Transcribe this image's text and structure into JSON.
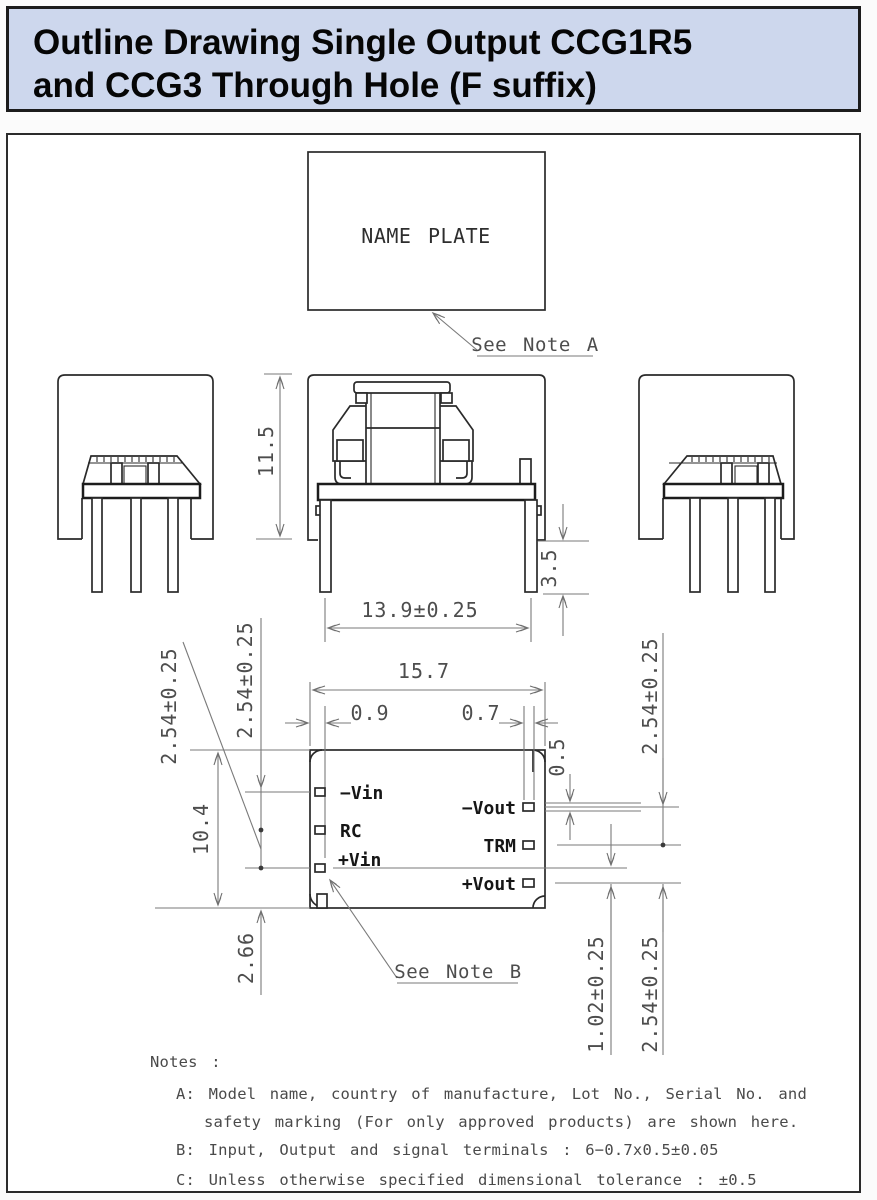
{
  "header": {
    "title_line1": "Outline Drawing Single Output CCG1R5",
    "title_line2": "and CCG3 Through Hole (F suffix)"
  },
  "colors": {
    "header_bg": "#cdd7ed",
    "border": "#1c1c1c",
    "outline": "#2a2a2a",
    "dimension": "#7a7a7a"
  },
  "name_plate": {
    "label": "NAME PLATE",
    "callout": "See Note A"
  },
  "bottom_view": {
    "callout": "See Note B",
    "pins_left": [
      "−Vin",
      "RC",
      "+Vin"
    ],
    "pins_right": [
      "−Vout",
      "TRM",
      "+Vout"
    ]
  },
  "dimensions": {
    "module_height": "11.5",
    "standoff_height": "3.5",
    "pin_row_span": "13.9±0.25",
    "body_length": "15.7",
    "pin_offset_left": "0.9",
    "terminal_width": "0.7",
    "terminal_thickness": "0.5",
    "body_depth": "10.4",
    "pitch_left_leader": "2.54±0.25",
    "pitch_left_top": "2.54±0.25",
    "pin_edge_inset": "2.66",
    "pitch_right_top": "2.54±0.25",
    "row_stagger": "1.02±0.25",
    "pitch_right_bottom": "2.54±0.25"
  },
  "notes": {
    "title": "Notes :",
    "a_line1": "A: Model name, country of manufacture, Lot No., Serial No. and",
    "a_line2": "safety marking (For only approved products) are shown here.",
    "b": "B: Input, Output and signal terminals : 6−0.7x0.5±0.05",
    "c": "C: Unless otherwise specified dimensional tolerance : ±0.5"
  }
}
